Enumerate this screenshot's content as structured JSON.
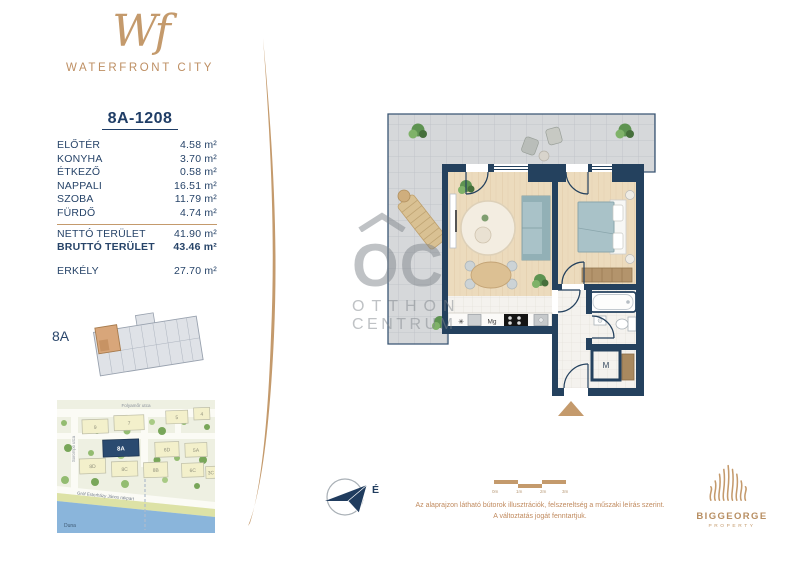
{
  "brand": {
    "monogram": "Wf",
    "name": "WATERFRONT CITY"
  },
  "unit": {
    "id": "8A-1208"
  },
  "rooms": [
    {
      "name": "ELŐTÉR",
      "area": "4.58 m²"
    },
    {
      "name": "KONYHA",
      "area": "3.70 m²"
    },
    {
      "name": "ÉTKEZŐ",
      "area": "0.58 m²"
    },
    {
      "name": "NAPPALI",
      "area": "16.51 m²"
    },
    {
      "name": "SZOBA",
      "area": "11.79 m²"
    },
    {
      "name": "FÜRDŐ",
      "area": "4.74 m²"
    }
  ],
  "totals": [
    {
      "name": "NETTÓ TERÜLET",
      "area": "41.90 m²"
    },
    {
      "name": "BRUTTÓ TERÜLET",
      "area": "43.46 m²"
    }
  ],
  "balcony": {
    "name": "ERKÉLY",
    "area": "27.70 m²"
  },
  "keyplan": {
    "label": "8A"
  },
  "map": {
    "streets": {
      "top": "Folyamőr utca",
      "left": "Sorompó utca",
      "embankment": "Gróf Esterházy János rakpart",
      "river": "Duna"
    },
    "buildings": [
      "9",
      "7",
      "5",
      "4",
      "8A",
      "6D",
      "5A",
      "8D",
      "8C",
      "8B",
      "6C",
      "3C"
    ],
    "highlighted": "8A"
  },
  "plan": {
    "labels": {
      "fridge": "✳",
      "dishwasher": "Mg",
      "mech": "M"
    }
  },
  "watermark": {
    "monogram": "OC",
    "line1": "OTTHON",
    "line2": "CENTRUM"
  },
  "compass": {
    "north": "É"
  },
  "scalebar": {
    "labels": [
      "0m",
      "1m",
      "2m",
      "3m"
    ]
  },
  "disclaimer": {
    "line1": "Az alaprajzon látható bútorok illusztrációk, felszereltség a műszaki leírás szerint.",
    "line2": "A változtatás jogát fenntartjuk."
  },
  "developer": {
    "name": "BIGGEORGE",
    "subtitle": "PROPERTY"
  },
  "colors": {
    "accent": "#C49A6C",
    "navy": "#24415E",
    "highlight": "#2A4A70"
  }
}
